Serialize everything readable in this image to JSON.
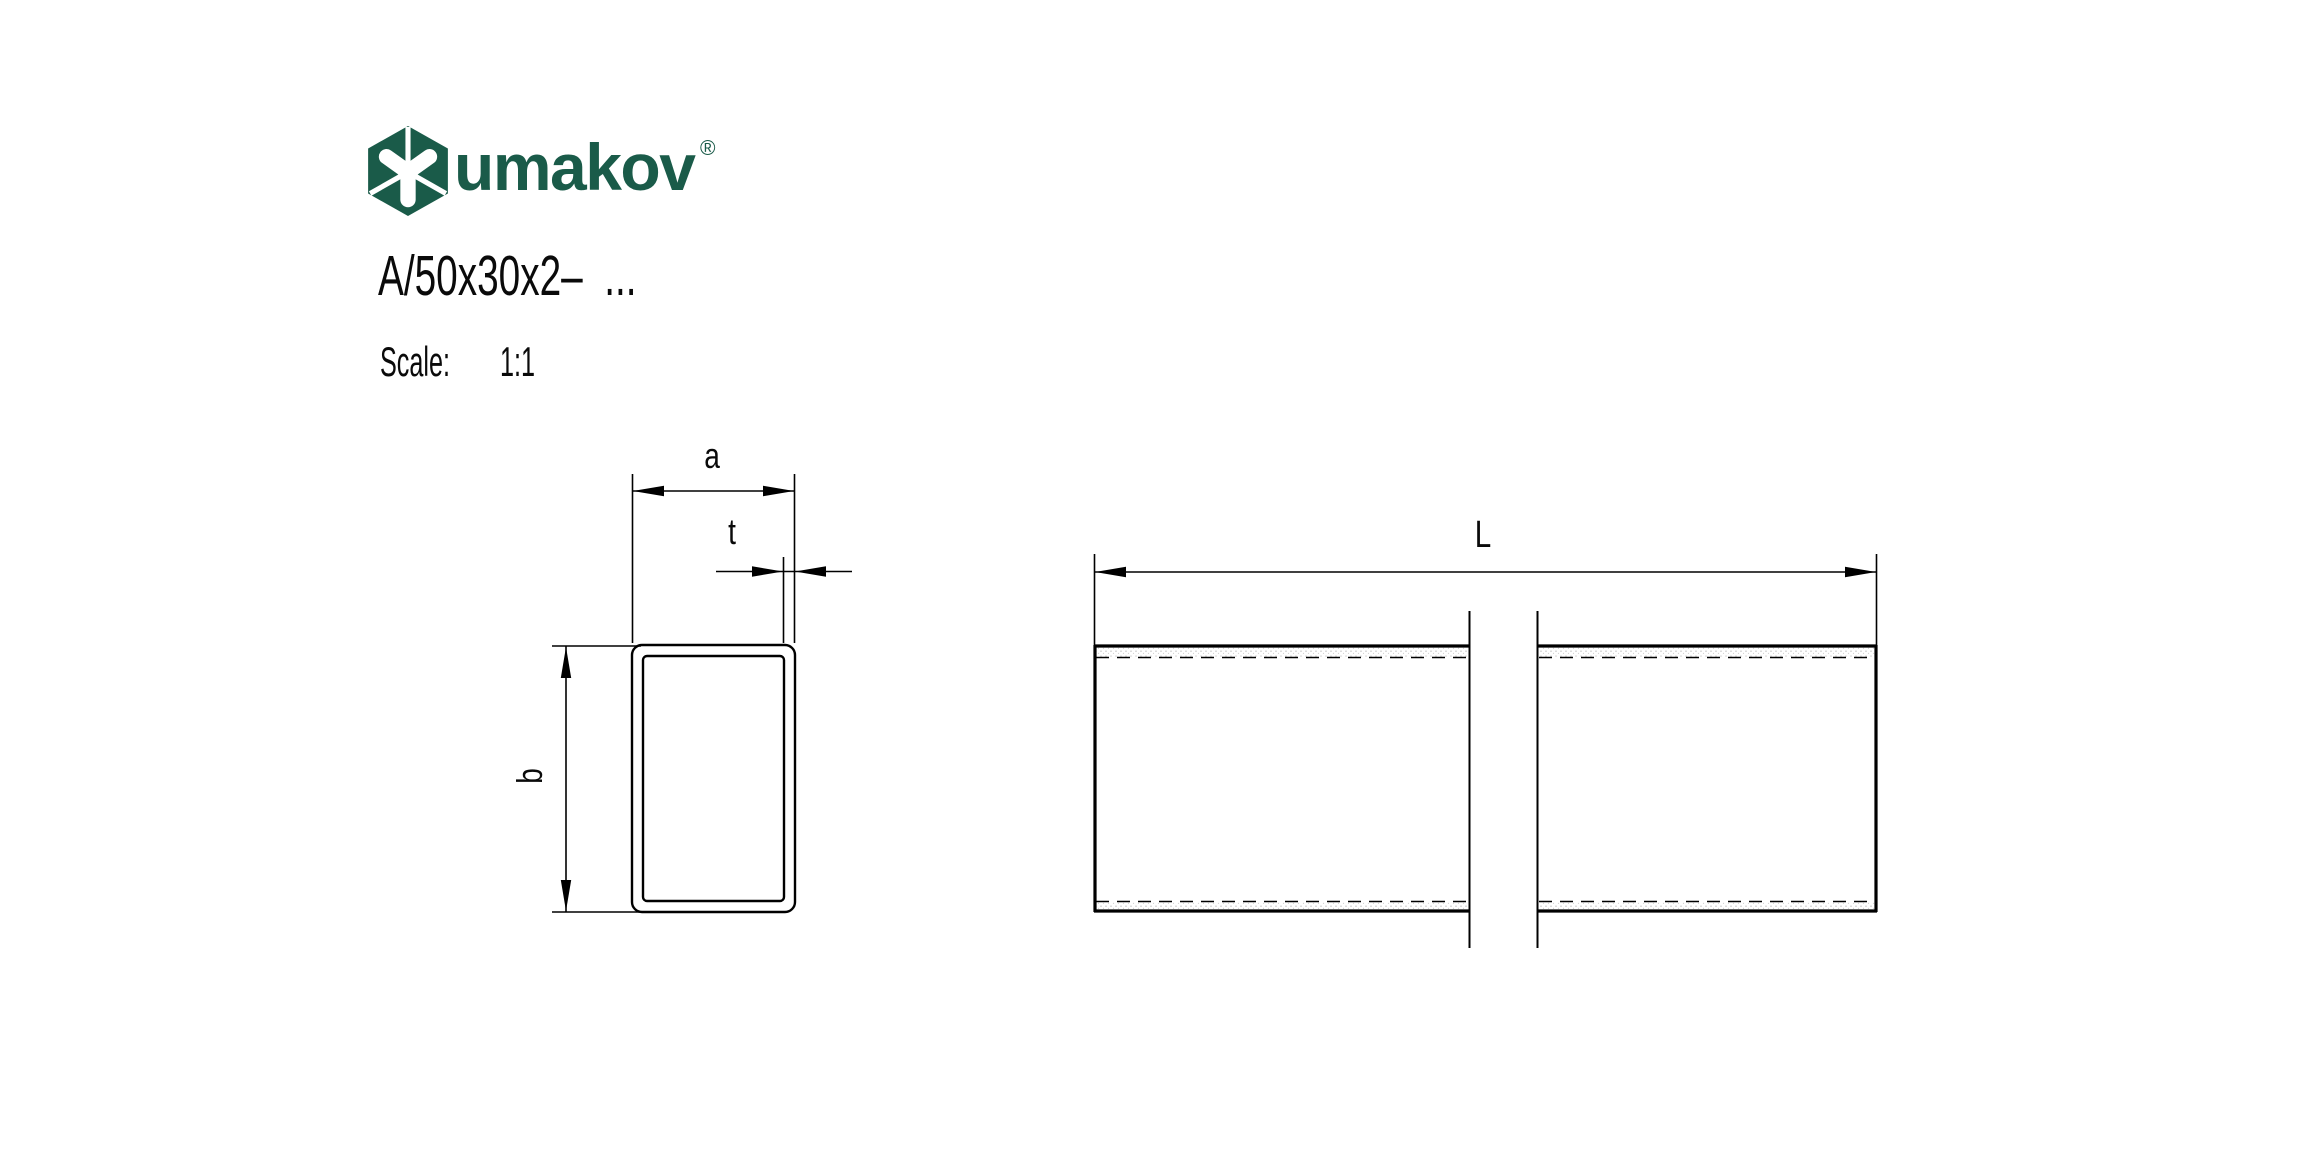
{
  "logo": {
    "brand": "umakov",
    "registered": "®",
    "icon": "umakov-hexagon-icon",
    "color": "#1a5b49"
  },
  "header": {
    "part_code": "A/50x30x2–  ...",
    "scale_label": "Scale:",
    "scale_value": "1:1"
  },
  "drawing": {
    "type": "technical-drawing",
    "views": {
      "cross_section": "rectangular tube profile section",
      "side": "tube length view with break lines"
    },
    "labels": {
      "width": "a",
      "thickness": "t",
      "height": "b",
      "length": "L"
    },
    "line_color": "#000000"
  }
}
